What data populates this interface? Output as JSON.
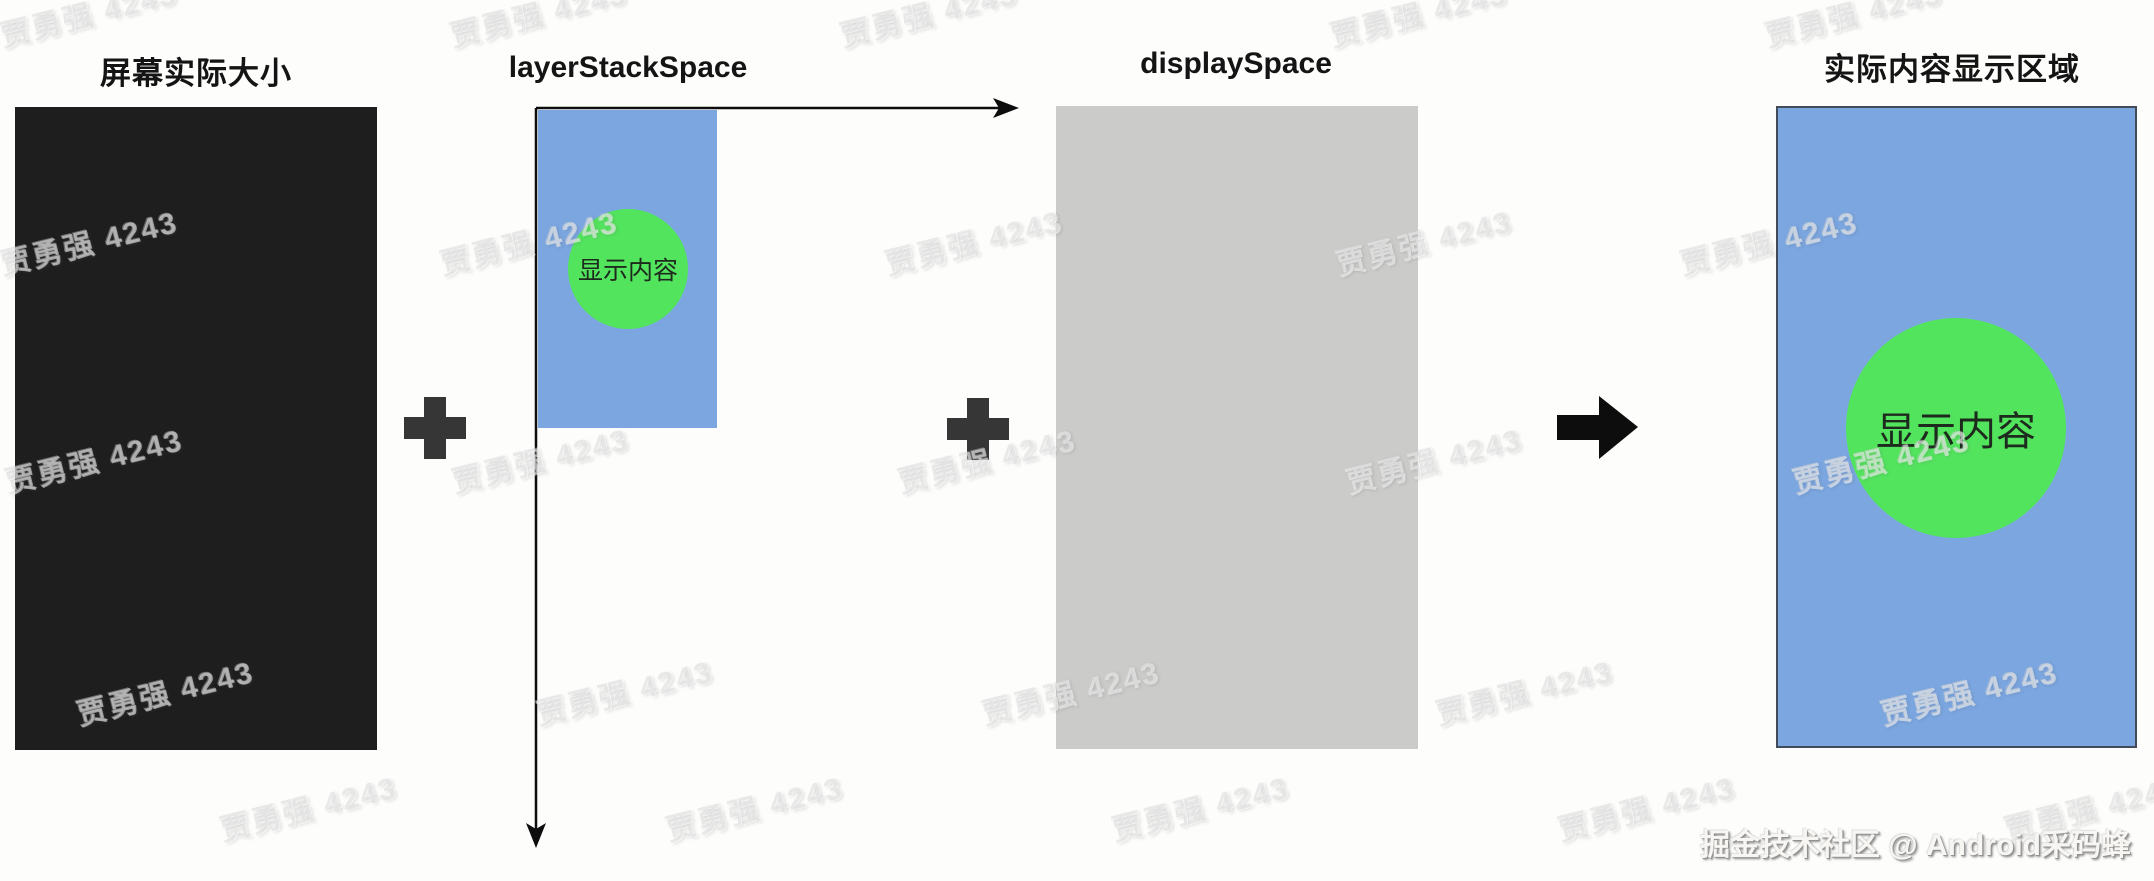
{
  "page": {
    "background": "#fdfdfc"
  },
  "titles": {
    "screen": "屏幕实际大小",
    "layer_stack_space": "layerStackSpace",
    "display_space": "displaySpace",
    "result_area": "实际内容显示区域"
  },
  "shapes": {
    "small_content_label": "显示内容",
    "large_content_label": "显示内容"
  },
  "credit": "掘金技术社区 @ Android采码蜂",
  "watermark": {
    "text": "贾勇强 4243"
  },
  "icons": {
    "plus_left": "plus-icon",
    "plus_right": "plus-icon",
    "transform_arrow": "arrow-right-icon",
    "axis_x": "axis-arrow-right-icon",
    "axis_y": "axis-arrow-down-icon"
  },
  "colors": {
    "screen_black": "#1e1e1e",
    "space_blue": "#7ba6e0",
    "content_green": "#53e45e",
    "display_gray": "#cbcbca",
    "plus_dark": "#363636",
    "arrow_black": "#0d0d0d",
    "result_border": "#424c59",
    "label_black": "#141414"
  }
}
